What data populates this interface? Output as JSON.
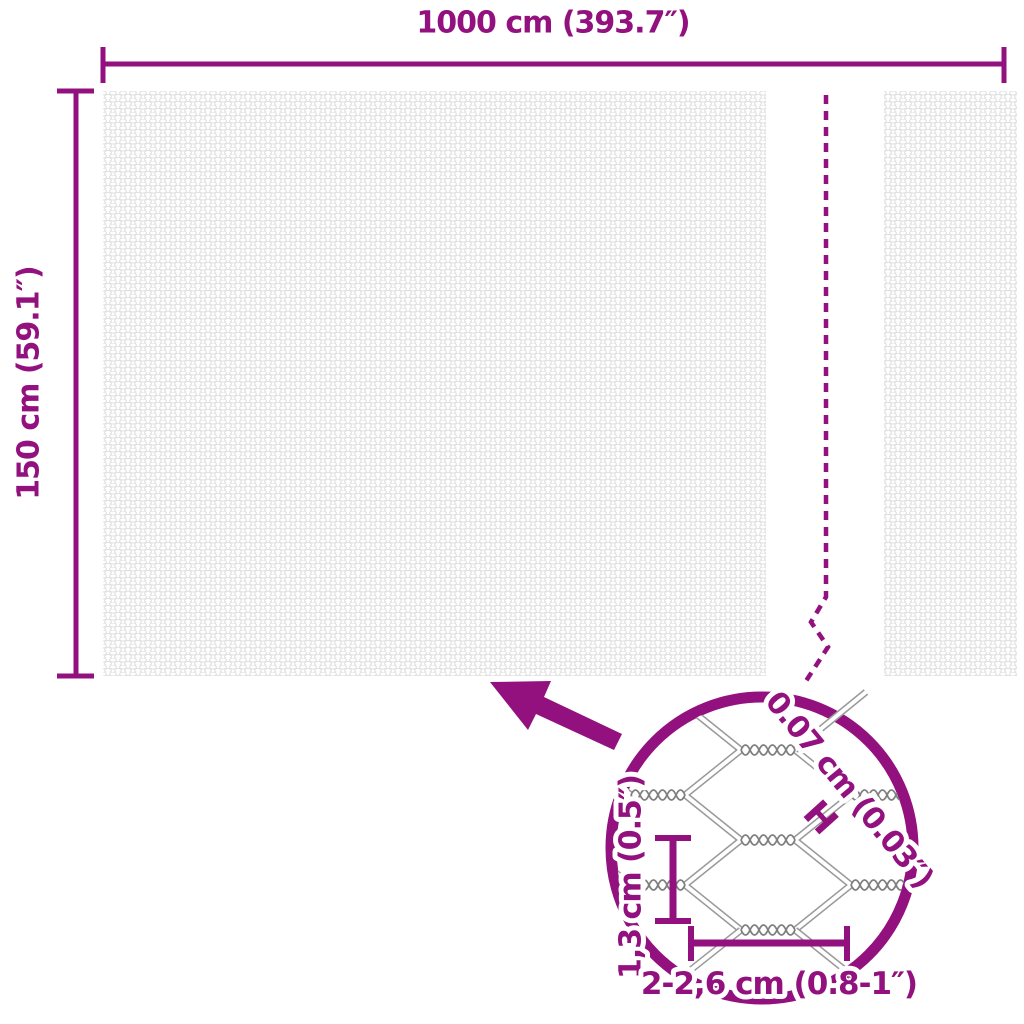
{
  "colors": {
    "accent": "#93107F",
    "wire_gray": "#9A9A9A",
    "mesh_texture_gray": "#E1E1E1",
    "background": "#FFFFFF"
  },
  "main_diagram": {
    "width_label": "1000 cm (393.7″)",
    "height_label": "150 cm (59.1″)"
  },
  "detail_view": {
    "wire_thickness_label": "0.07 cm (0.03″)",
    "wire_thickness_marker": "H",
    "mesh_height_label": "1,3 cm (0.5″)",
    "mesh_width_label": "2-2,6 cm (0.8-1″)"
  }
}
